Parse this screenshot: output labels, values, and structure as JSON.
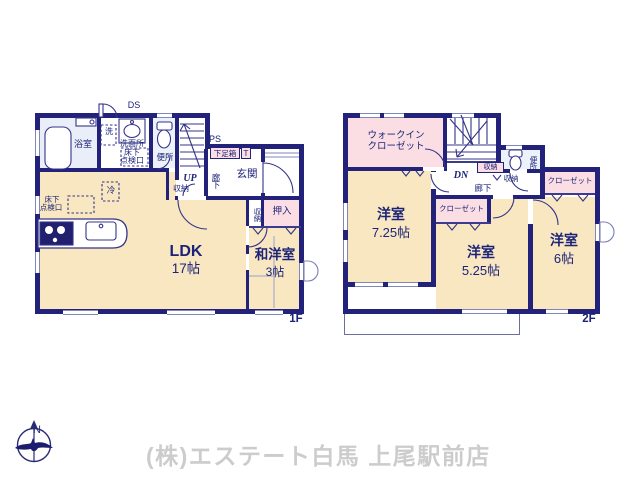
{
  "colors": {
    "wall": "#22227b",
    "text": "#1c2378",
    "room_cream": "#f8e7c1",
    "closet_pink": "#fadee4",
    "wet_blue": "#e9eef8",
    "window_line": "#8087bd",
    "company_gray": "#cccccc"
  },
  "branding": {
    "company": "(株)エステート白馬 上尾駅前店",
    "north": "N"
  },
  "floor1": {
    "floor_label": "1F",
    "labels": {
      "ds": "DS",
      "ps": "PS",
      "bath": "浴室",
      "wash_machine": "洗",
      "washroom": "洗面所",
      "washroom_sub1": "床下",
      "washroom_sub2": "点検口",
      "toilet": "便所",
      "up": "UP",
      "stair_storage": "収納",
      "hallway": "廊下",
      "entrance": "玄関",
      "shoe_box": "下足箱",
      "shoe_box_t": "T",
      "fridge": "冷",
      "hatch1": "床下",
      "hatch2": "点検口",
      "ldk": "LDK",
      "ldk_size": "17帖",
      "side_storage": "収納",
      "oshiire": "押入",
      "washitsu": "和洋室",
      "washitsu_size": "3帖"
    }
  },
  "floor2": {
    "floor_label": "2F",
    "labels": {
      "wic1": "ウォークイン",
      "wic2": "クローゼット",
      "dn": "DN",
      "stair_storage": "収納",
      "hall_storage": "収納",
      "toilet": "便所",
      "hallway": "廊下",
      "closet_right": "クローゼット",
      "closet_center": "クローゼット",
      "room1": "洋室",
      "room1_size": "7.25帖",
      "room2": "洋室",
      "room2_size": "5.25帖",
      "room3": "洋室",
      "room3_size": "6帖"
    }
  }
}
